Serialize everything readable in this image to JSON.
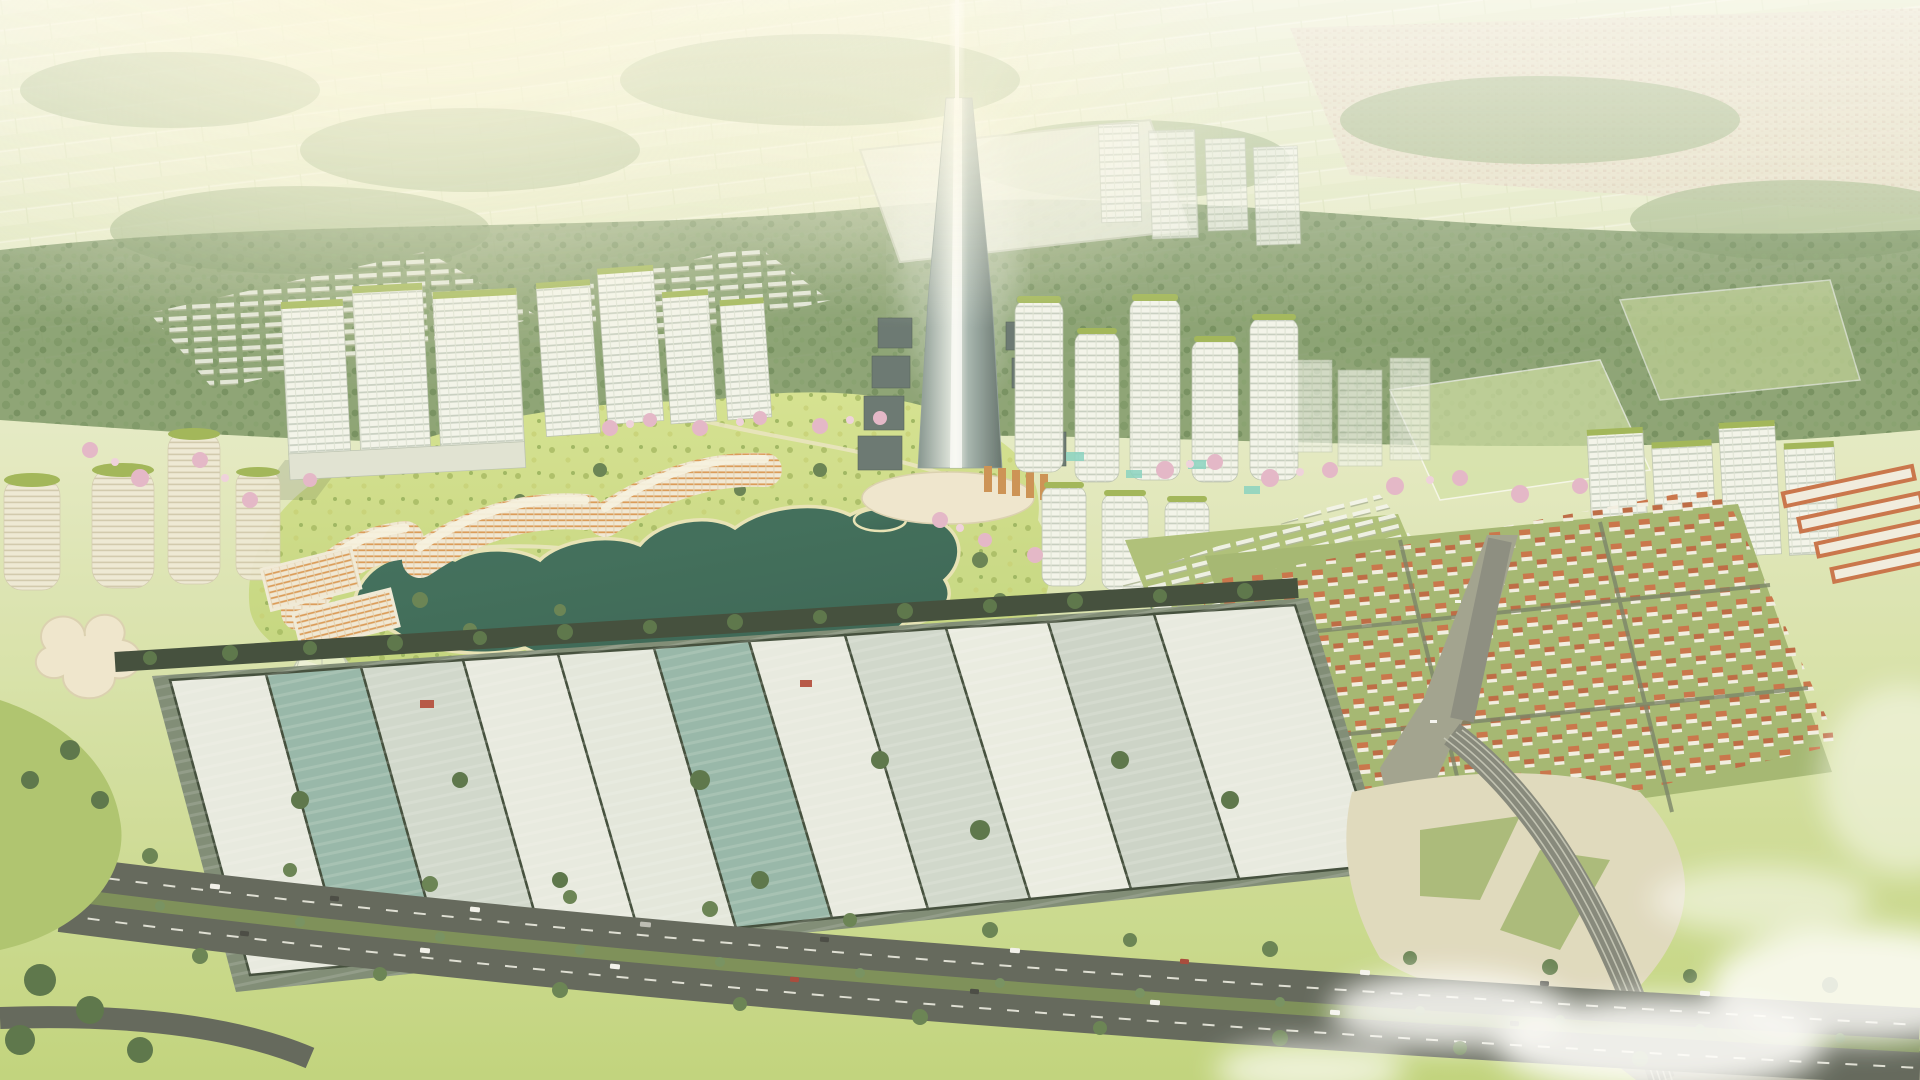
{
  "scene": {
    "type": "aerial-architectural-render",
    "description": "Bird's-eye 3D masterplan rendering of a new urban township in hazy golden daylight. A slender glass supertall tower with a vertical light beam rises at the center, surrounded by white high-rise clusters, curved orange-faced lakeside apartments, a large landscaped park with an organically shaped dark-teal lake, an orange-roofed villa grid to the east, a long strip of industrial/construction plots behind a tree-lined canal, a multi-lane tree-divided highway across the foreground, and a ribbed road bridge crossing an olive river at lower right. Distant farmland and forest fade into bright haze at the horizon.",
    "time_of_day": "hazy golden daylight",
    "landmarks": [
      {
        "id": "central-tower",
        "label": "central supertall tower with light beam"
      },
      {
        "id": "light-beam",
        "label": "vertical light beam above tower"
      },
      {
        "id": "central-park",
        "label": "large landscaped central park"
      },
      {
        "id": "lake",
        "label": "organic dark-teal lake"
      },
      {
        "id": "left-tower-cluster",
        "label": "white slab high-rise cluster (west)"
      },
      {
        "id": "east-tower-cluster",
        "label": "rounded balcony towers east of spire"
      },
      {
        "id": "lakeside-crescents",
        "label": "curved orange-facade apartment crescents"
      },
      {
        "id": "villa-district",
        "label": "orange-roofed villa grid (east)"
      },
      {
        "id": "rowhouse-district",
        "label": "white rowhouse township"
      },
      {
        "id": "industrial-strip",
        "label": "industrial / construction plots"
      },
      {
        "id": "canal",
        "label": "tree-lined canal"
      },
      {
        "id": "highway",
        "label": "divided foreground highway with traffic"
      },
      {
        "id": "river",
        "label": "olive river at lower right"
      },
      {
        "id": "cable-bridge",
        "label": "ribbed road bridge over river"
      },
      {
        "id": "greenhouse-dome",
        "label": "glass lattice dome pavilion"
      },
      {
        "id": "blossom-trees",
        "label": "pink cherry-blossom tree rows"
      },
      {
        "id": "clouds",
        "label": "low clouds, bottom right"
      },
      {
        "id": "farmland-horizon",
        "label": "hazy farmland and forest horizon"
      }
    ]
  },
  "palette": {
    "sky": "#f1f2d8",
    "haze": "#f8f6e2",
    "farmland": "#dde6bf",
    "farmlandLight": "#e7ecca",
    "townDistant": "#e4dcc6",
    "forest": "#6b8a57",
    "forestDark": "#4e6b3f",
    "forestLight": "#9db483",
    "park": "#bdd276",
    "parkLight": "#d3e18c",
    "lake": "#336856",
    "lakeDeep": "#2b5a4a",
    "shore": "#e7e2b4",
    "towerWhite": "#f3f5ee",
    "towerShade": "#c6cdbf",
    "glassDark": "#66787a",
    "roofGreen": "#9ab24e",
    "facadeOrange": "#d9954f",
    "villaRoof": "#c66a3f",
    "villaGround": "#9db36a",
    "blossom": "#e3b3c8",
    "blossomLight": "#efd0de",
    "road": "#565c52",
    "roadLight": "#83857a",
    "median": "#72874f",
    "canal": "#33402f",
    "industrialBase": "#75846f",
    "industrialLight": "#e7eae2",
    "industrialMid": "#cdd6cc",
    "industrialTeal": "#8fb3a6",
    "river": "#9a9c8a",
    "pavedCream": "#ded8bd",
    "cloud": "#ffffff",
    "beam": "#ffffff",
    "treeDot": "#5d7a49",
    "creamBuilding": "#efe6cd"
  }
}
